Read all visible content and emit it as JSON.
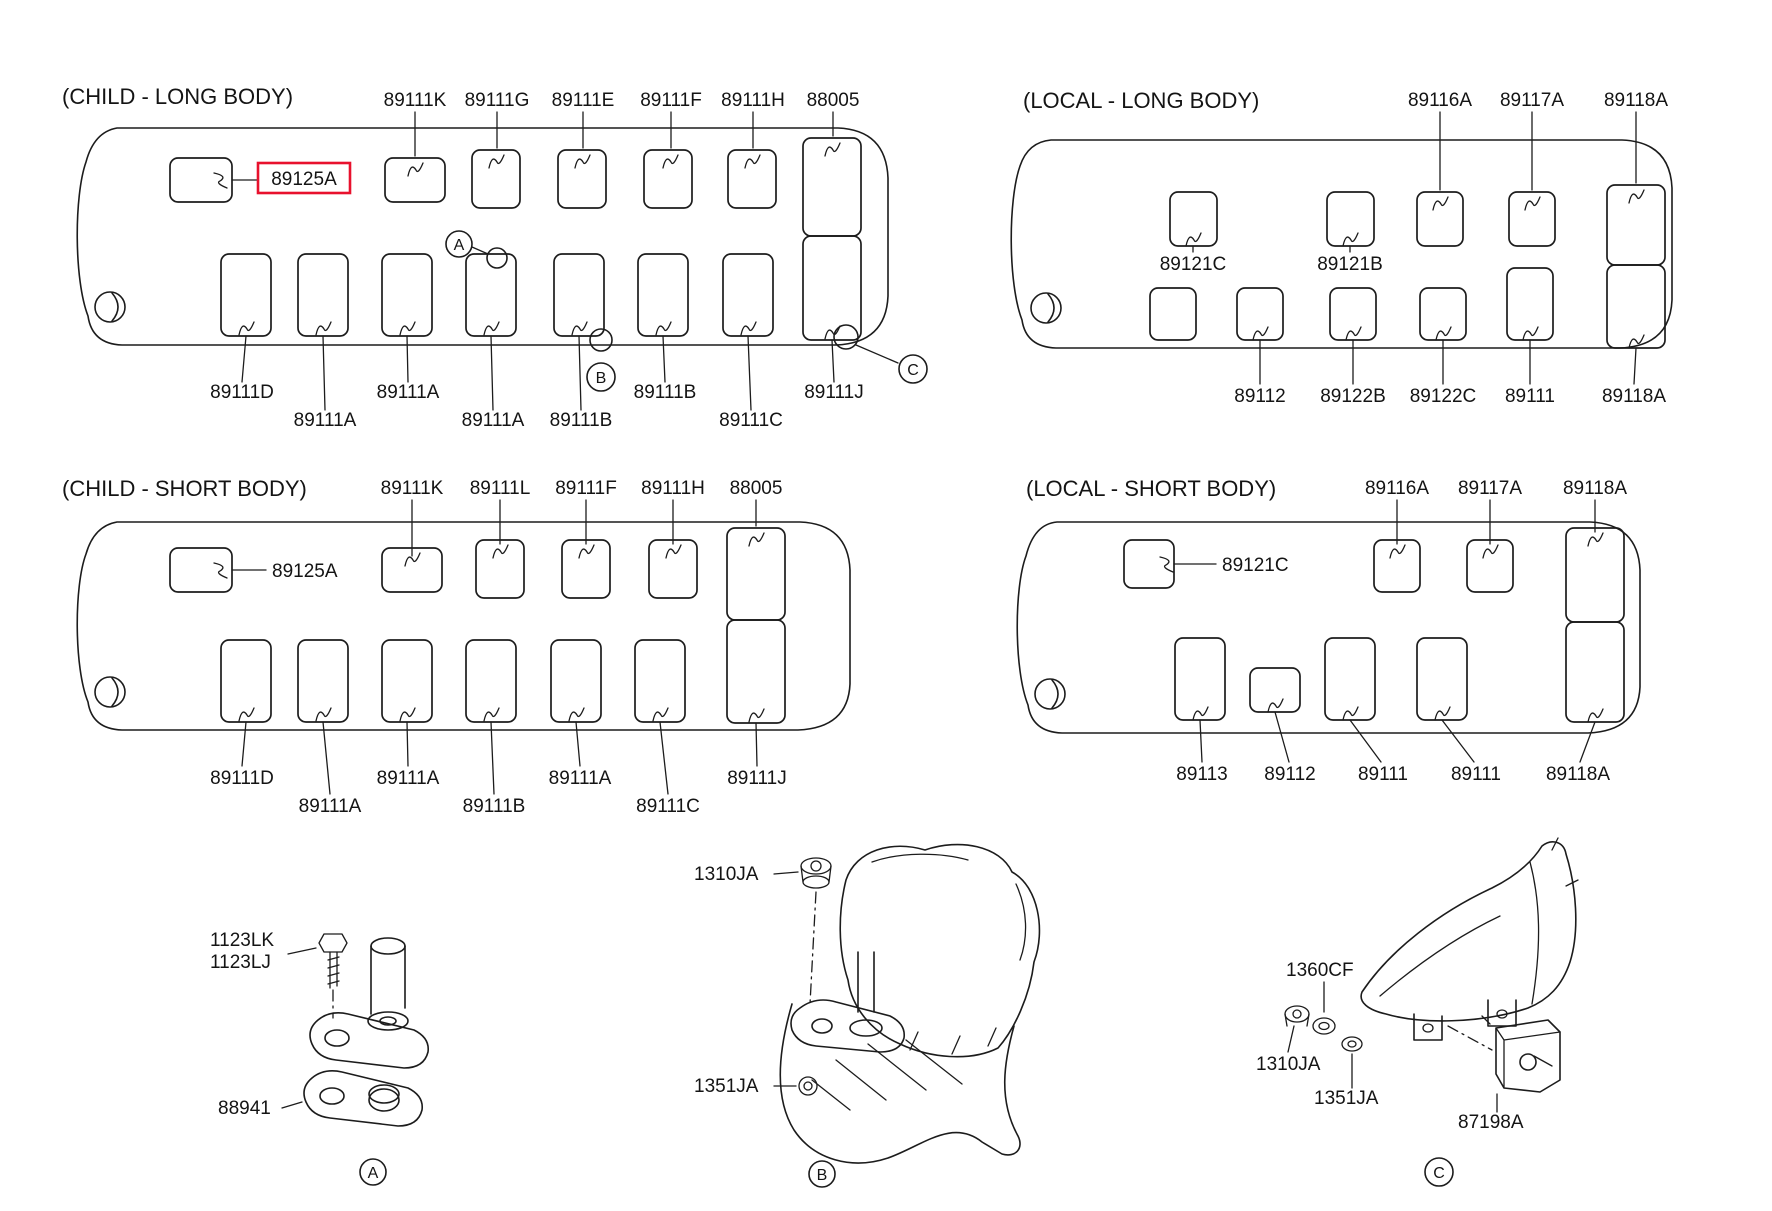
{
  "colors": {
    "ink": "#1c1c1c",
    "highlight": "#e8112d",
    "background": "#ffffff"
  },
  "panels": {
    "child_long": {
      "title": "(CHILD - LONG BODY)",
      "top_labels": [
        "89111K",
        "89111G",
        "89111E",
        "89111F",
        "89111H",
        "88005"
      ],
      "highlighted_part": "89125A",
      "row1_labels": [
        "89111D",
        "89111A",
        "89111B",
        "89111J"
      ],
      "row2_labels": [
        "89111A",
        "89111A",
        "89111B",
        "89111C"
      ]
    },
    "local_long": {
      "title": "(LOCAL - LONG BODY)",
      "top_labels": [
        "89116A",
        "89117A",
        "89118A"
      ],
      "mid_labels": [
        "89121C",
        "89121B"
      ],
      "bottom_labels": [
        "89112",
        "89122B",
        "89122C",
        "89111",
        "89118A"
      ]
    },
    "child_short": {
      "title": "(CHILD - SHORT BODY)",
      "top_labels": [
        "89111K",
        "89111L",
        "89111F",
        "89111H",
        "88005"
      ],
      "part_89125a": "89125A",
      "row1_labels": [
        "89111D",
        "89111A",
        "89111A",
        "89111J"
      ],
      "row2_labels": [
        "89111A",
        "89111B",
        "89111C"
      ]
    },
    "local_short": {
      "title": "(LOCAL - SHORT BODY)",
      "top_labels": [
        "89116A",
        "89117A",
        "89118A"
      ],
      "part_89121c": "89121C",
      "bottom_labels": [
        "89113",
        "89112",
        "89111",
        "89111",
        "89118A"
      ]
    }
  },
  "details": {
    "a": {
      "callout": "A",
      "bolt_label_1": "1123LK",
      "bolt_label_2": "1123LJ",
      "plate_label": "88941"
    },
    "b": {
      "callout": "B",
      "nut_label": "1310JA",
      "washer_label": "1351JA"
    },
    "c": {
      "callout": "C",
      "collar_label": "1360CF",
      "nut_label": "1310JA",
      "washer_label": "1351JA",
      "bracket_label": "87198A"
    }
  }
}
